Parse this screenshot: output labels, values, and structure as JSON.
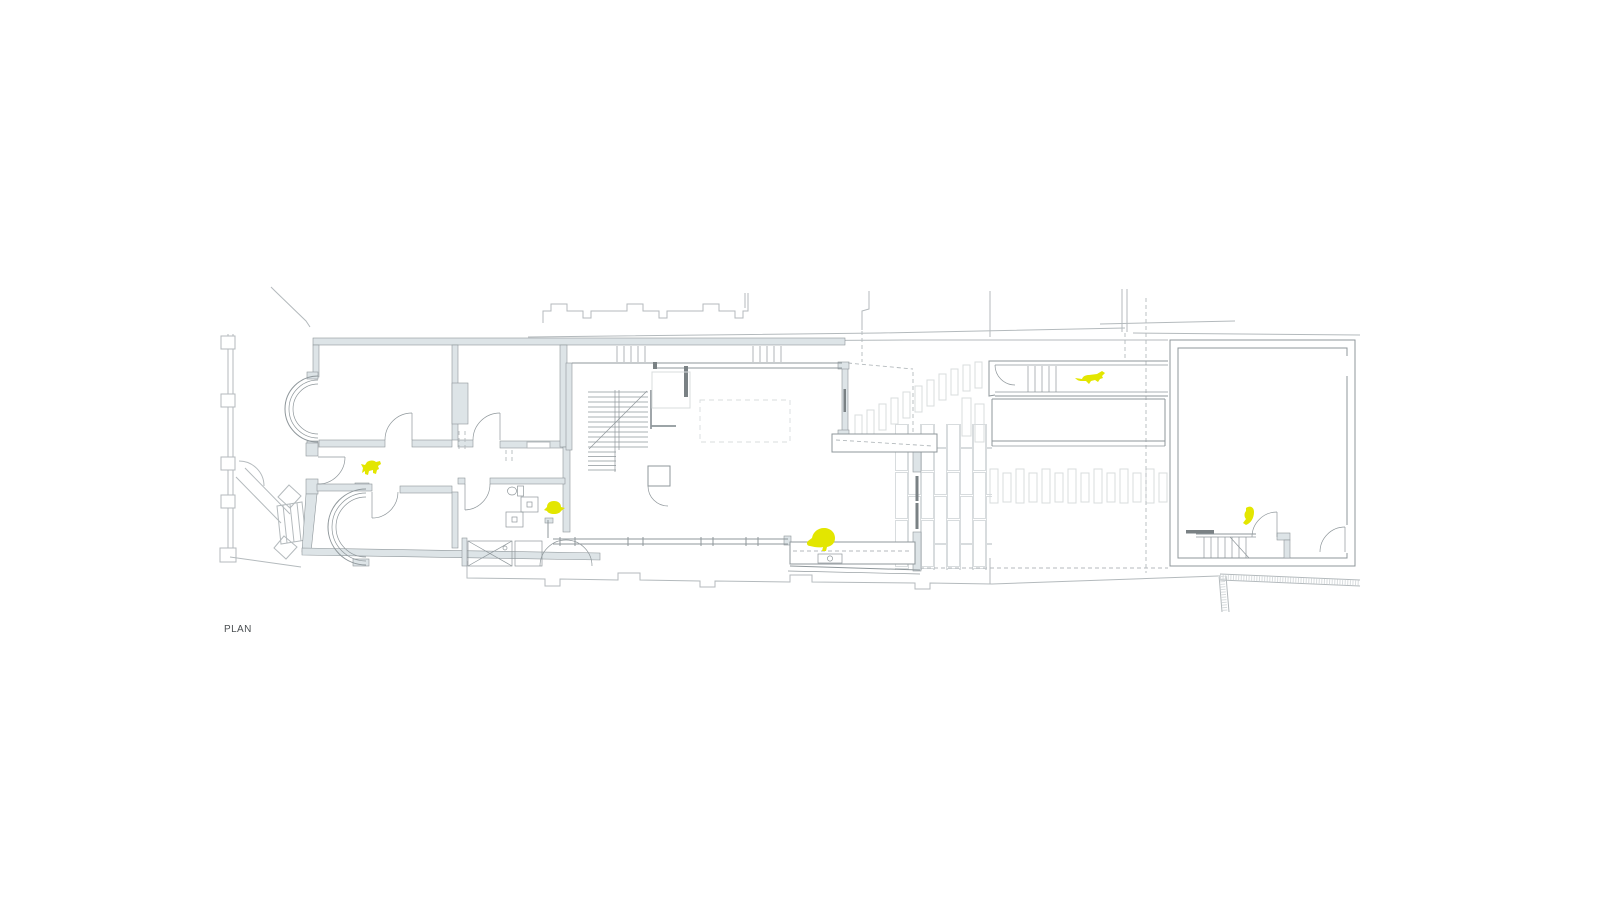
{
  "sheet": {
    "label": "PLAN"
  },
  "colors": {
    "background": "#ffffff",
    "line": "#8f979b",
    "line_light": "#b4babd",
    "line_faint": "#d8dcde",
    "wall_fill": "#dde4e7",
    "dark_fill": "#7a8184",
    "accent_yellow": "#e3e600",
    "label_color": "#4b4f52"
  },
  "figures": [
    {
      "name": "dog-figure",
      "location": "entrance hall"
    },
    {
      "name": "tortoise-figure",
      "location": "bathroom"
    },
    {
      "name": "bird-figure",
      "location": "kitchen bench"
    },
    {
      "name": "cat-figure",
      "location": "garden side passage"
    },
    {
      "name": "parrot-figure",
      "location": "garden studio"
    }
  ]
}
